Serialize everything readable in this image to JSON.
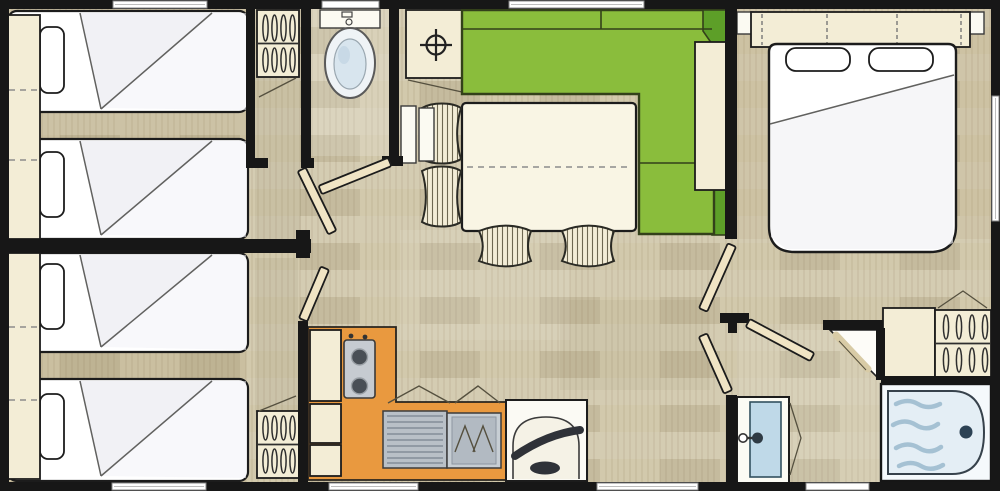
{
  "meta": {
    "type": "floor-plan",
    "width_px": 1000,
    "height_px": 491,
    "visible_text": "none"
  },
  "palette": {
    "wall": "#171717",
    "outline": "#1c1c1c",
    "floor": "#cfc6a9",
    "beige": "#f3edd6",
    "bed_white": "#ffffff",
    "sofa_green": "#8abd3c",
    "sofa_green_dark": "#5d9f28",
    "sofa_seam": "#33401a",
    "orange": "#e9993f",
    "steel": "#b9c0c7",
    "steel_stripe": "#848e98",
    "tub_fill": "#e4eef5",
    "wave": "#a5c1d3",
    "water": "#bfd9e8",
    "drain": "#2c4254",
    "plank": "#f0e4c4",
    "window": "#ffffff",
    "dash": "#8c8c8c",
    "toilet_inner": "#d8e5ee"
  },
  "counts": {
    "rooms": 7,
    "single_beds": 4,
    "double_beds": 1,
    "wardrobes": 3,
    "windows": 8,
    "open_door_leaves": 6,
    "dining_chairs": 4
  },
  "rooms": [
    {
      "name": "bedroom-twin-1",
      "furniture": [
        "single-bed",
        "single-bed",
        "pillow",
        "pillow",
        "headboard-shelf",
        "window"
      ]
    },
    {
      "name": "bedroom-twin-2",
      "furniture": [
        "single-bed",
        "single-bed",
        "pillow",
        "pillow",
        "headboard-shelf",
        "window"
      ]
    },
    {
      "name": "closet-strip",
      "furniture": [
        "wardrobe-hanging",
        "wardrobe-hanging"
      ]
    },
    {
      "name": "wc",
      "furniture": [
        "toilet",
        "window"
      ]
    },
    {
      "name": "living-dining",
      "furniture": [
        "corner-sofa-green",
        "dining-table",
        "chair",
        "chair",
        "chair",
        "chair",
        "radiator",
        "water-heater-cabinet",
        "window"
      ]
    },
    {
      "name": "kitchen",
      "furniture": [
        "l-shaped-counter",
        "hob-two-burners",
        "sink-with-drainboard",
        "base-cabinets",
        "wall-cabinets",
        "fridge-unit",
        "window"
      ]
    },
    {
      "name": "master-bedroom",
      "furniture": [
        "double-bed",
        "pillow",
        "pillow",
        "overhead-headboard-cabinet",
        "window",
        "side-window"
      ]
    },
    {
      "name": "bathroom",
      "furniture": [
        "bathtub",
        "washbasin-cabinet",
        "wardrobe-hanging",
        "door-leaf",
        "window"
      ]
    }
  ]
}
